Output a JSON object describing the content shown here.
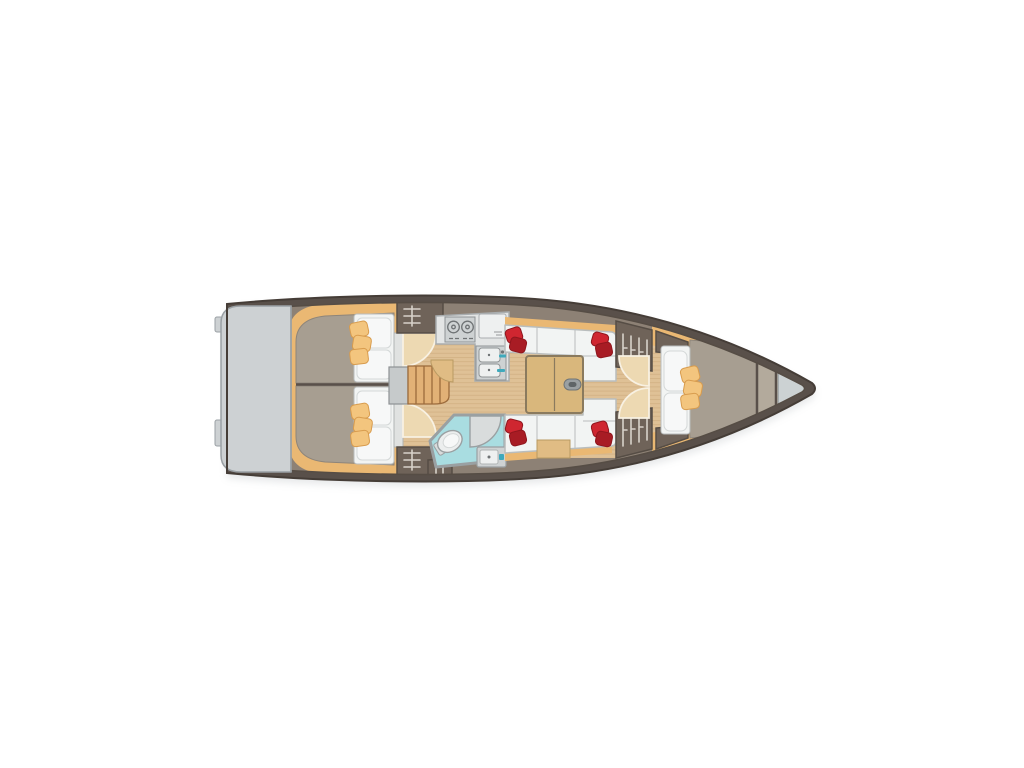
{
  "figure": {
    "label": "Sailing yacht interior layout floor plan, bow pointing right",
    "type": "floor-plan",
    "orientation": "bow-right"
  },
  "components": {
    "swim_platform": 1,
    "aft_double_cabins": 2,
    "aft_berth_cushions_per_cabin": 3,
    "companionway_treads": 4,
    "galley_burners": 2,
    "galley_sinks": 2,
    "galley_worktops": 1,
    "head_toilet": 1,
    "head_basin": 1,
    "head_shower_door": 1,
    "saloon_settees": 2,
    "saloon_red_pillow_clusters": 4,
    "saloon_table_leaves": 2,
    "vented_lockers": 5,
    "forward_cabin_pillows": 2,
    "forward_cabin_cushions": 3,
    "anchor_locker": 1
  },
  "palette": {
    "background": "#ffffff",
    "shadow": "#aeb4b8",
    "hull": "#59504a",
    "hull_edge": "#453d37",
    "interior_band": "#8d8175",
    "lining": "#eab873",
    "platform": "#cdd1d3",
    "platform_border": "#9aa0a4",
    "berth": "#a79e91",
    "berth_border": "#8e857a",
    "floor": "#dfc196",
    "floor_stripe": "#c9a878",
    "locker": "#6f6359",
    "locker_border": "#564d45",
    "locker_vent": "#d8d2ca",
    "bulkhead": "#e0e2e1",
    "bulkhead_border": "#b0b4b4",
    "step_box": "#c6cacb",
    "step_box_border": "#8e9294",
    "stairs": "#e2b176",
    "stairs_tread": "#9c6b3c",
    "door_leaf": "#edd9b2",
    "door_edge": "#f8f1e2",
    "counter": "#e3e5e5",
    "counter_border": "#a9adaf",
    "appliance": "#ced2d3",
    "appliance_border": "#8f9395",
    "appliance_detail": "#6f7375",
    "basin": "#eef0f0",
    "seat_wedge": "#e0bc84",
    "seat_wedge_border": "#b99a62",
    "bath_floor": "#a9dde1",
    "bath_wall": "#9aa0a2",
    "fixture": "#eceeee",
    "fixture_border": "#9aa0a2",
    "shower": "#d9dcdc",
    "teal": "#3fa9bc",
    "sofa": "#f2f4f3",
    "sofa_border": "#b9bdbd",
    "pillow": "#f7f8f8",
    "pillow_border": "#d4d8d8",
    "cushion": "#f3c57e",
    "cushion_border": "#d89c4e",
    "red": "#cf2630",
    "red_dark": "#a81c24",
    "red_border": "#8f161d",
    "table": "#d9b77c",
    "table_border": "#8a7a5e",
    "handle": "#9aa0a2",
    "handle_border": "#6f7476",
    "handle_slot": "#5f6567",
    "divider": "#b3aa9c",
    "anchor": "#ccd2d3"
  }
}
